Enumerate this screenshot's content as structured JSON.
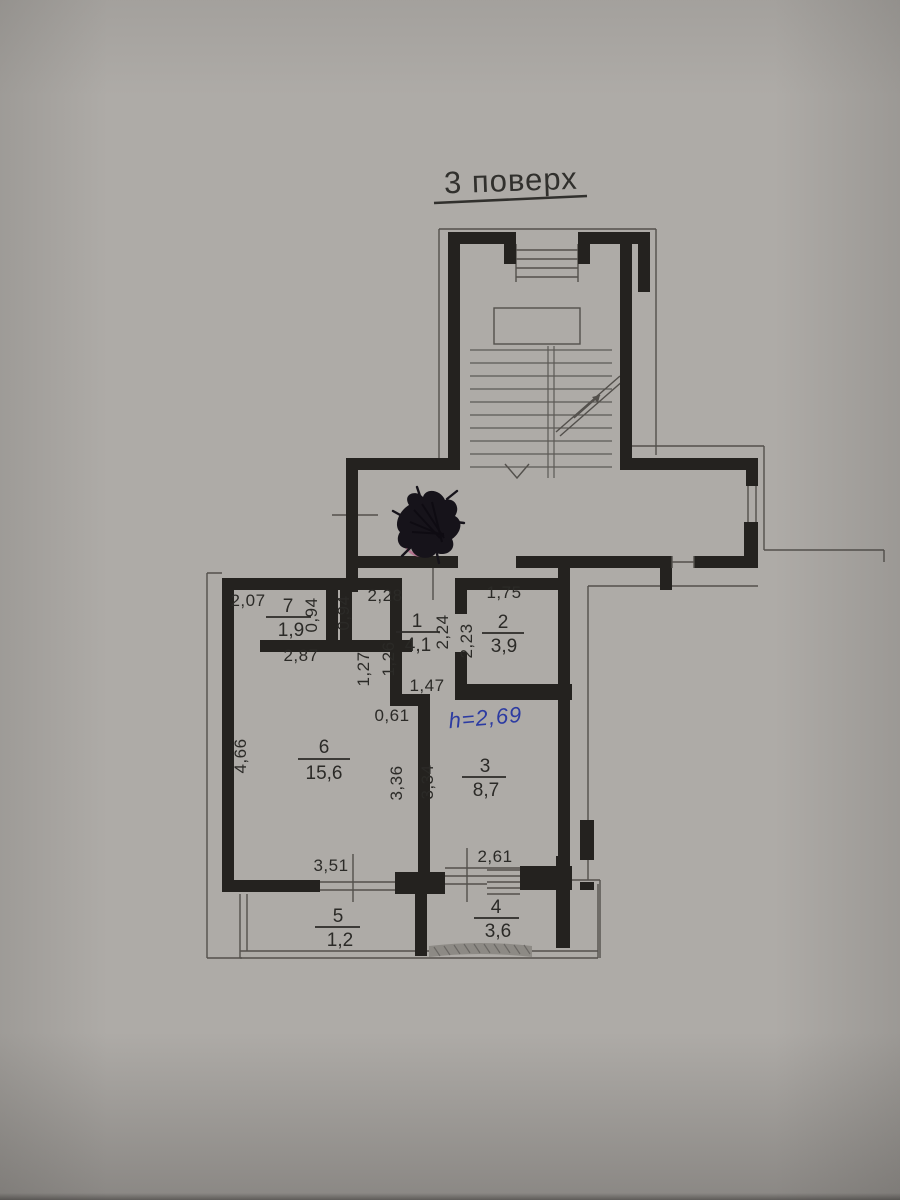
{
  "title": "3 поверх",
  "note": "h=2,69",
  "rooms": [
    {
      "number": "7",
      "area": "1,9"
    },
    {
      "number": "1",
      "area": "4,1"
    },
    {
      "number": "2",
      "area": "3,9"
    },
    {
      "number": "6",
      "area": "15,6"
    },
    {
      "number": "3",
      "area": "8,7"
    },
    {
      "number": "5",
      "area": "1,2"
    },
    {
      "number": "4",
      "area": "3,6"
    }
  ],
  "dimensions": {
    "w207": "2,07",
    "h094a": "0,94",
    "h094b": "0,94",
    "w228": "2,28",
    "h224": "2,24",
    "h223": "2,23",
    "w175": "1,75",
    "w287": "2,87",
    "h127": "1,27",
    "h126": "1,26",
    "w147": "1,47",
    "w061": "0,61",
    "h466": "4,66",
    "h336": "3,36",
    "h334": "3,34",
    "w351": "3,51",
    "w261": "2,61"
  },
  "colors": {
    "paper": "#b1aeaa",
    "ink_lines": "#24221f",
    "thin_lines": "#53504c",
    "text": "#2b2a27",
    "blue_pen": "#2c3ba2",
    "stamp_pink": "#b4688a",
    "scribble": "#16131a"
  }
}
